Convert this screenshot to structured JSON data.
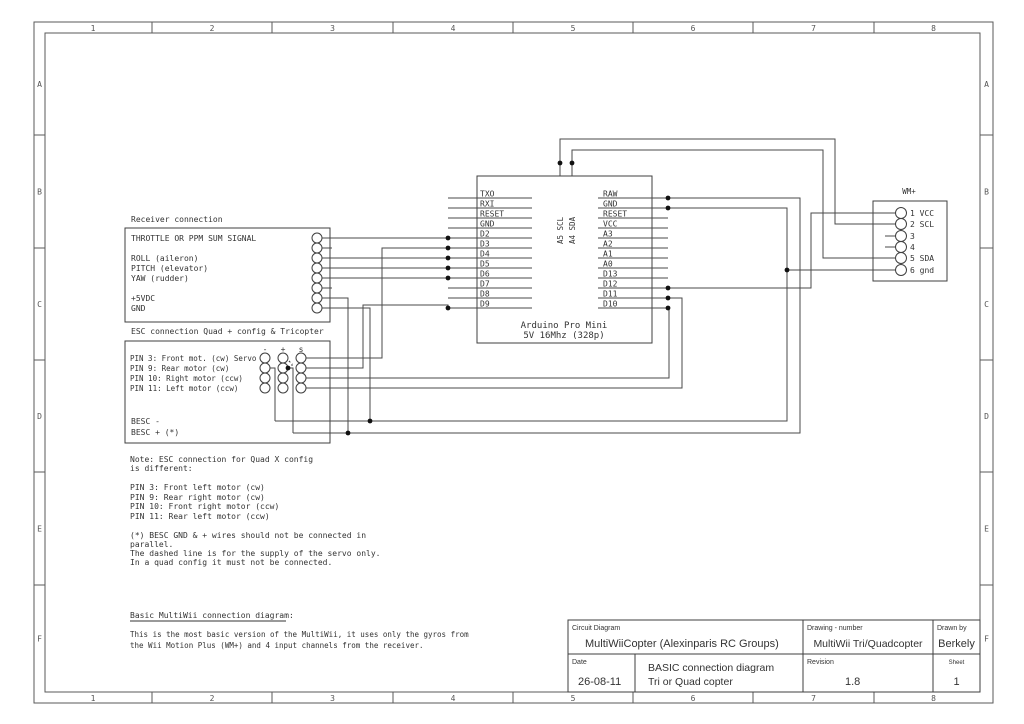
{
  "colors": {
    "bg": "#ffffff",
    "wire": "#4a4a4a",
    "box": "#3f3f3f",
    "text": "#333333",
    "frame": "#5a5a5a",
    "frame_text": "#555555",
    "dot": "#111111"
  },
  "frame": {
    "columns": [
      "1",
      "2",
      "3",
      "4",
      "5",
      "6",
      "7",
      "8"
    ],
    "rows": [
      "A",
      "B",
      "C",
      "D",
      "E",
      "F"
    ]
  },
  "receiver": {
    "title": "Receiver connection",
    "labels": [
      "THROTTLE OR PPM SUM SIGNAL",
      "",
      "ROLL (aileron)",
      "PITCH (elevator)",
      "YAW (rudder)",
      "",
      "+5VDC",
      "GND"
    ]
  },
  "esc": {
    "title": "ESC connection Quad + config  & Tricopter",
    "headers": [
      "-",
      "+",
      "s"
    ],
    "rows": [
      "PIN 3: Front mot. (cw) Servo",
      "PIN 9: Rear motor (cw)",
      "PIN 10: Right motor (ccw)",
      "PIN 11: Left motor (ccw)"
    ],
    "besc_minus": "BESC -",
    "besc_plus": "BESC + (*)"
  },
  "arduino": {
    "left_pins": [
      "TXO",
      "RXI",
      "RESET",
      "GND",
      "D2",
      "D3",
      "D4",
      "D5",
      "D6",
      "D7",
      "D8",
      "D9"
    ],
    "right_pins": [
      "RAW",
      "GND",
      "RESET",
      "VCC",
      "A3",
      "A2",
      "A1",
      "A0",
      "D13",
      "D12",
      "D11",
      "D10"
    ],
    "top_pins": [
      "A5 SCL",
      "A4 SDA"
    ],
    "caption_line1": "Arduino Pro Mini",
    "caption_line2": "5V 16Mhz (328p)"
  },
  "wm": {
    "title": "WM+",
    "pins": [
      "1 VCC",
      "2 SCL",
      "3",
      "4",
      "5 SDA",
      "6 gnd"
    ]
  },
  "notes": [
    {
      "y": 462,
      "t": "Note: ESC connection for Quad X config"
    },
    {
      "y": 471,
      "t": "is different:"
    },
    {
      "y": 490,
      "t": "PIN 3: Front left motor (cw)"
    },
    {
      "y": 500,
      "t": "PIN 9: Rear right motor (cw)"
    },
    {
      "y": 509,
      "t": "PIN 10: Front right motor (ccw)"
    },
    {
      "y": 519,
      "t": "PIN 11: Rear left motor (ccw)"
    },
    {
      "y": 538,
      "t": "(*) BESC GND & + wires should not be connected in"
    },
    {
      "y": 547,
      "t": "parallel."
    },
    {
      "y": 556,
      "t": "The dashed line is for the supply of the servo only."
    },
    {
      "y": 565,
      "t": "In a quad config it must not be connected."
    }
  ],
  "footer": {
    "heading": "Basic MultiWii connection diagram:",
    "lines": [
      "This is the most basic version of the MultiWii, it uses only the gyros from",
      "the Wii Motion Plus (WM+) and 4 input channels from the receiver."
    ]
  },
  "title_block": {
    "field1_label": "Circuit Diagram",
    "field1_value": "MultiWiiCopter (Alexinparis RC Groups)",
    "drawing_label": "Drawing - number",
    "drawing_value": "MultiWii Tri/Quadcopter",
    "drawn_label": "Drawn by",
    "drawn_value": "Berkely",
    "date_label": "Date",
    "date_value": "26-08-11",
    "desc_line1": "BASIC connection diagram",
    "desc_line2": "Tri or Quad copter",
    "revision_label": "Revision",
    "revision_value": "1.8",
    "sheet_label": "Sheet",
    "sheet_value": "1"
  }
}
